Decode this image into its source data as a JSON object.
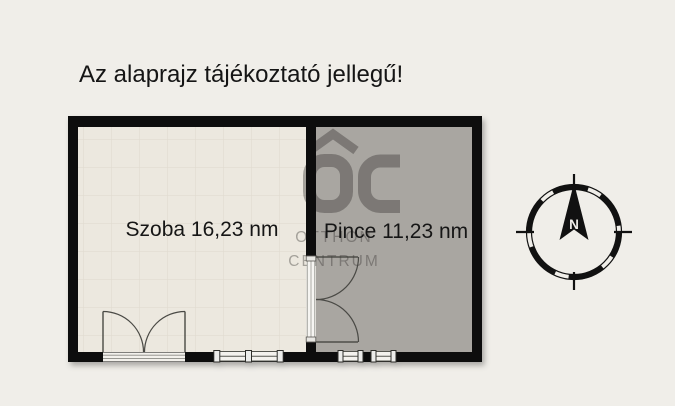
{
  "title": "Az alaprajz tájékoztató jellegű!",
  "rooms": [
    {
      "name": "Szoba",
      "area": "16,23",
      "unit": "nm",
      "label": "Szoba 16,23 nm"
    },
    {
      "name": "Pince",
      "area": "11,23",
      "unit": "nm",
      "label": "Pince 11,23 nm"
    }
  ],
  "watermark": {
    "logo": "OC",
    "line1": "OTTHON",
    "line2": "CENTRUM"
  },
  "compass": {
    "north": "N"
  },
  "colors": {
    "background": "#f0eee9",
    "wall": "#0c0c0c",
    "szoba-floor": "#ece8df",
    "pince-floor": "#a9a6a1",
    "opening-fill": "#f3f1ec",
    "watermark": "#31302d",
    "text": "#151515"
  }
}
